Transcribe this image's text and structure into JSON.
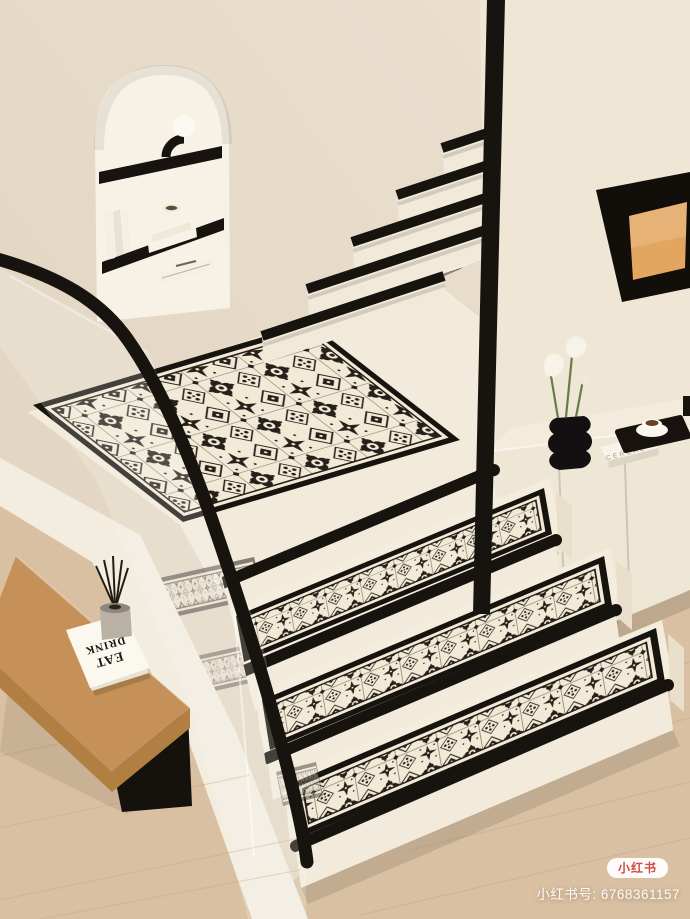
{
  "canvas": {
    "width": 690,
    "height": 919
  },
  "watermark": {
    "badge": "小红书",
    "id_label": "小红书号: 6768361157"
  },
  "objects": {
    "bench_book": {
      "line1": "EAT",
      "line2": "DRINK"
    },
    "cabinet_book": {
      "spine": "CEREAL"
    }
  },
  "colors": {
    "wall": "#e7dccb",
    "wall_right": "#f0e6d6",
    "stair_cream": "#f2eadb",
    "mat_bg": "#f2ead7",
    "mat_ink": "#26201a",
    "black": "#17130f",
    "wood": "#d9c0a2",
    "wood_seam": "#c9ab87",
    "bench_tan": "#c69158",
    "bench_shade": "#b27f43",
    "art_inner": "#e2a660",
    "white_paint": "#f3ede0",
    "badge_red": "#cf4a41"
  }
}
